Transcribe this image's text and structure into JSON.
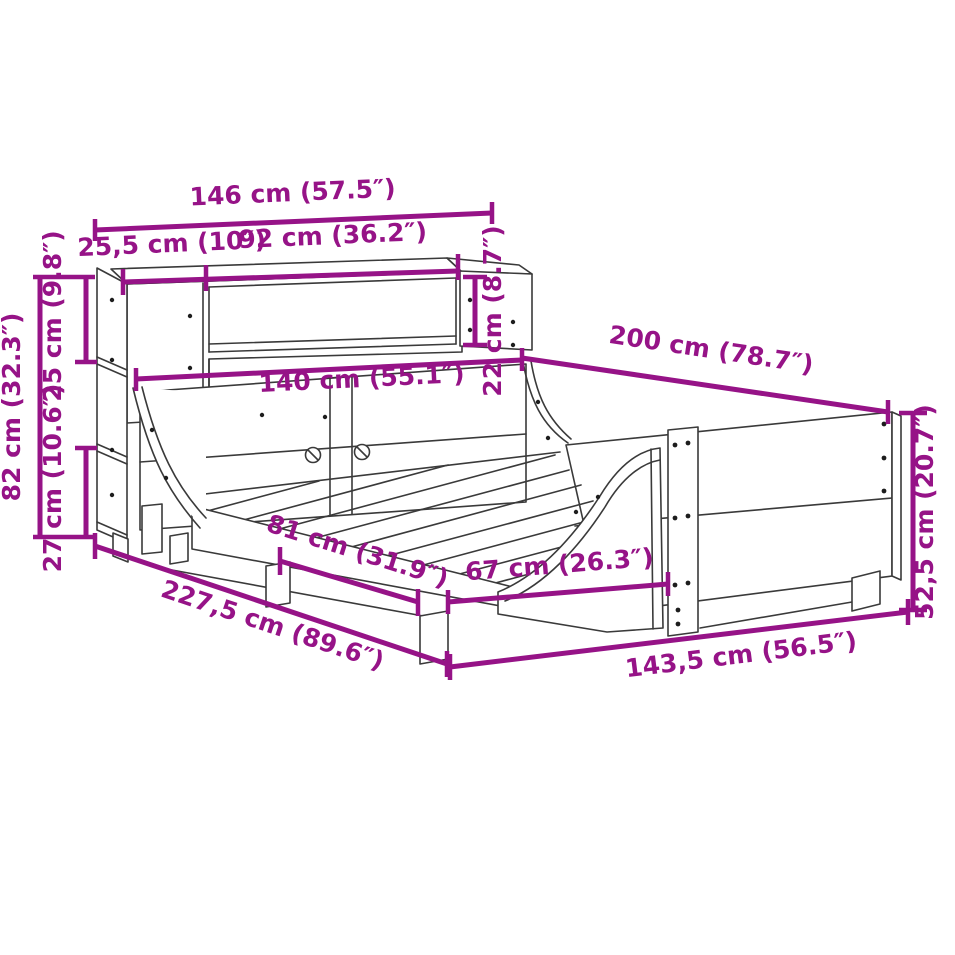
{
  "diagram": {
    "type": "furniture-dimension-diagram",
    "subject": "bookcase-headboard-bed-frame",
    "colors": {
      "accent": "#961387",
      "line": "#3a3a3a",
      "background": "#ffffff"
    },
    "dimensions": {
      "total_width": "146 cm (57.5″)",
      "shelf_left_section": "25,5 cm (10″)",
      "shelf_opening_width": "92 cm (36.2″)",
      "shelf_opening_height": "22 cm (8.7″)",
      "shelf_top_section_height": "25 cm (9.8″)",
      "headboard_total_height": "82 cm (32.3″)",
      "shelf_lower_section_height": "27 cm (10.6″)",
      "bed_width": "140 cm (55.1″)",
      "bed_length": "200 cm (78.7″)",
      "footboard_height": "52,5 cm (20.7″)",
      "side_rail_length": "81 cm (31.9″)",
      "foot_section_length": "67 cm (26.3″)",
      "total_length": "227,5 cm (89.6″)",
      "total_width_at_foot": "143,5 cm (56.5″)"
    }
  }
}
